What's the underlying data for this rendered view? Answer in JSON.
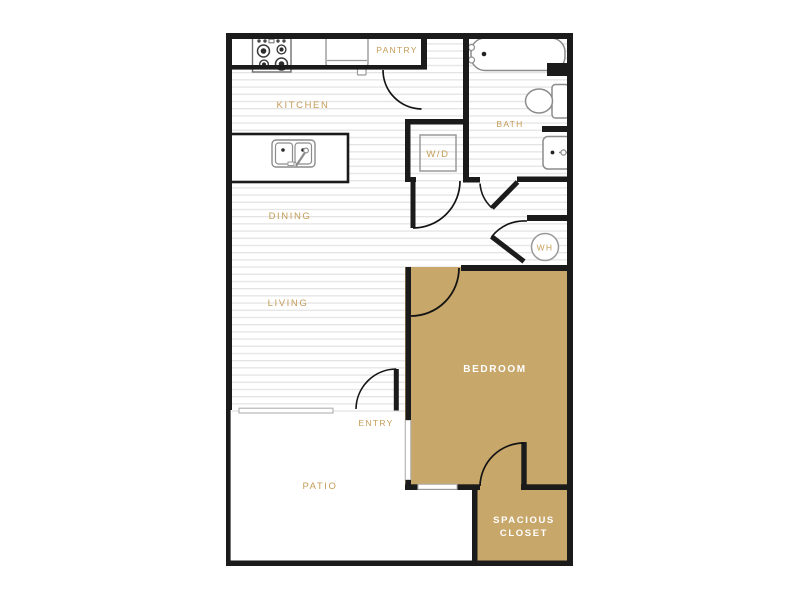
{
  "floorplan": {
    "title": "Apartment Floor Plan",
    "rooms": {
      "kitchen": {
        "label": "KITCHEN"
      },
      "pantry": {
        "label": "PANTRY"
      },
      "bath": {
        "label": "BATH"
      },
      "washer_dryer": {
        "label": "W/D"
      },
      "dining": {
        "label": "DINING"
      },
      "living": {
        "label": "LIVING"
      },
      "water_heater": {
        "label": "WH"
      },
      "bedroom": {
        "label": "BEDROOM"
      },
      "entry": {
        "label": "ENTRY"
      },
      "patio": {
        "label": "PATIO"
      },
      "closet": {
        "label_line1": "SPACIOUS",
        "label_line2": "CLOSET"
      }
    },
    "fixtures": [
      "stove-icon",
      "pantry-counter-icon",
      "island-sink-icon",
      "bathtub-icon",
      "toilet-icon",
      "bathroom-sink-icon",
      "washer-dryer-box-icon",
      "water-heater-circle-icon"
    ],
    "colors": {
      "accent_tan": "#c8a76a",
      "label_gold": "#c49d58",
      "wall_black": "#1b1b1b",
      "floor_stripe": "#e4e4e4",
      "room_label_white": "#ffffff"
    }
  }
}
